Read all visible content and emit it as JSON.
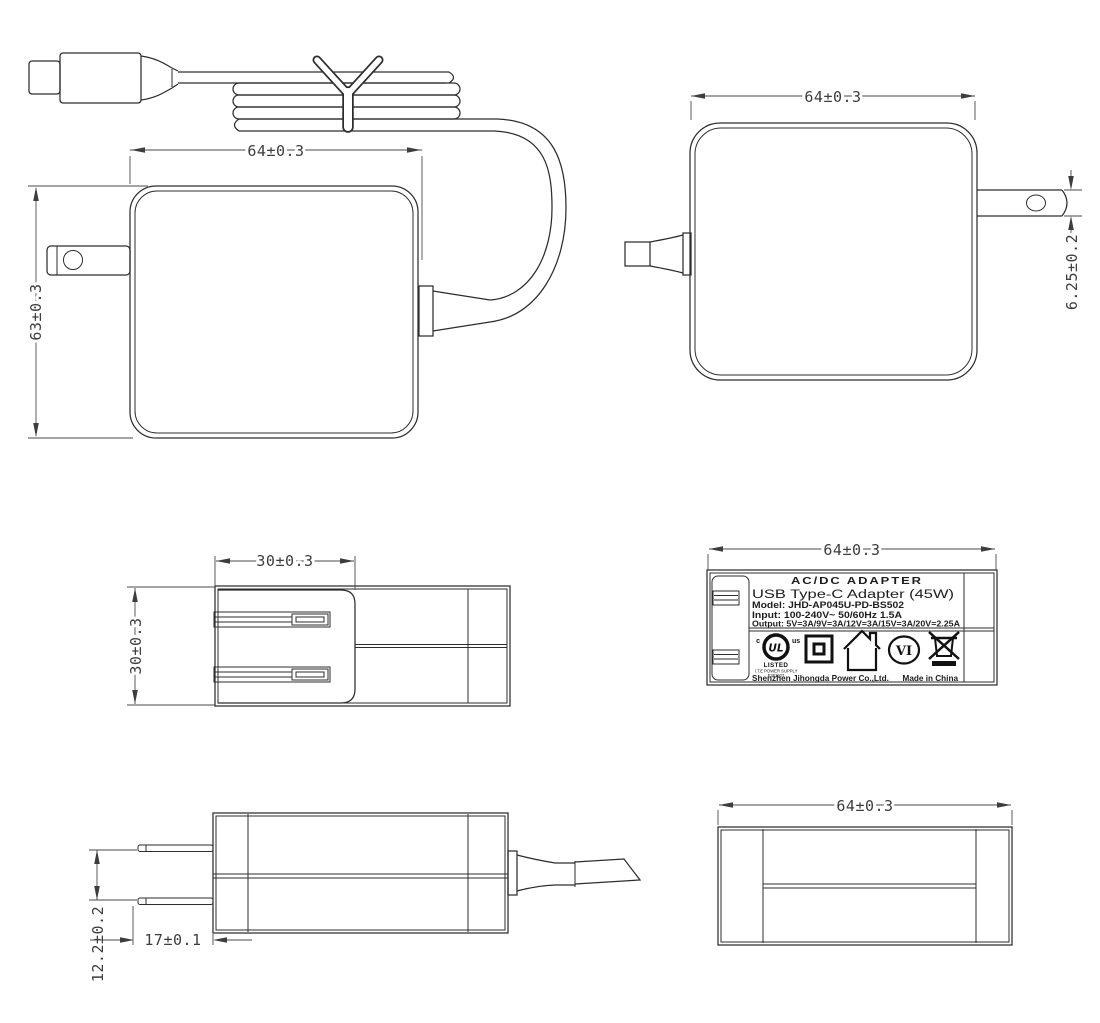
{
  "page": {
    "title": "AC/DC Adapter Technical Drawing",
    "background": "#ffffff",
    "line_color": "#2d2d2d",
    "dim_color": "#3d3d3d"
  },
  "dims": {
    "front_width": "64±0.3",
    "front_height": "63±0.3",
    "back_width": "64±0.3",
    "back_pin_thickness": "6.25±0.2",
    "top_plug_width": "30±0.3",
    "top_depth": "30±0.3",
    "label_width": "64±0.3",
    "side_pin_pitch": "12.2±0.2",
    "side_pin_length": "17±0.1",
    "bottom_width": "64±0.3"
  },
  "label": {
    "title": "AC/DC ADAPTER",
    "subtitle": "USB Type-C Adapter (45W)",
    "model": "Model: JHD-AP045U-PD-BS502",
    "input": "Input: 100-240V~ 50/60Hz 1.5A",
    "output": "Output: 5V=3A/9V=3A/12V=3A/15V=3A/20V=2.25A",
    "manufacturer": "Shenzhen Jihongda Power Co.,Ltd.",
    "origin": "Made in China",
    "ul_c": "c",
    "ul_letters": "UL",
    "ul_us": "us",
    "ul_listed": "LISTED",
    "ul_line1": "I.T.E POWER SUPPLY",
    "ul_line2": "E361927",
    "efficiency_mark": "VI"
  }
}
